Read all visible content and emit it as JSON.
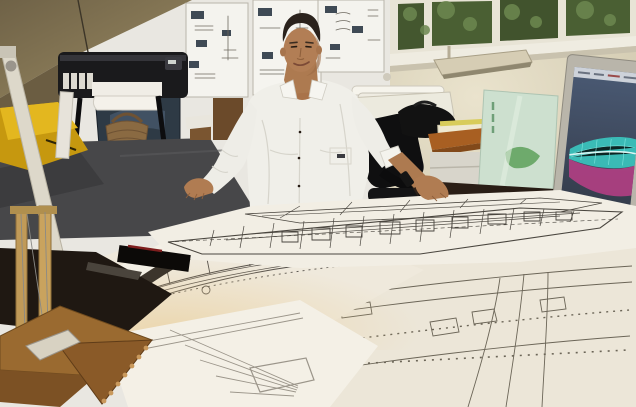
{
  "meta": {
    "description": "Yacht designer in a white shirt standing in his studio office, leaning over large blueprint drawings of yacht deck plans spread across a desk; plotter, pinboard posters, windows with foliage, wooden half-model and a Dell monitor showing a 3D CAD hull render."
  },
  "monitor": {
    "brand_label": "DELL",
    "screen_content": "3d-cad-yacht-hull-wireframe",
    "cad_teal": "#39cfc6",
    "cad_magenta": "#c23f8a"
  },
  "palette": {
    "wall_beige": "#8a7a58",
    "wall_white": "#e9e7e1",
    "wall_cream": "#d9d2bd",
    "window_foliage": "#44572f",
    "floor_gray": "#474749",
    "desk_dark": "#241a12",
    "paper": "#f2eee4",
    "pencil_line": "#55504a",
    "shirt_white": "#f0efe9",
    "skin_tan": "#b07c52",
    "hair_brown": "#2a221c",
    "hull_yellow": "#d7a715",
    "basket_tan": "#8a6a42",
    "poster_green": "#cde0cf",
    "wood_brown": "#8a5a28",
    "sticky_yellow": "#ddc93f"
  },
  "objects": [
    "sloped-beige-wall",
    "pinboard-posters",
    "large-format-plotter",
    "paper-roll",
    "wicker-basket",
    "framed-yacht-picture",
    "yellow-hull",
    "lamp-pole",
    "window-band",
    "wall-light",
    "drafting-table",
    "office-chair",
    "black-bag",
    "side-table",
    "white-cabinet",
    "leaning-poster",
    "dell-monitor",
    "cad-hull-render",
    "desk",
    "keyboard",
    "yellow-notepad",
    "black-notebook",
    "micrometer-tool",
    "designer",
    "blueprint-sheets",
    "yacht-deck-plan",
    "wooden-half-model",
    "trophy-posts"
  ]
}
